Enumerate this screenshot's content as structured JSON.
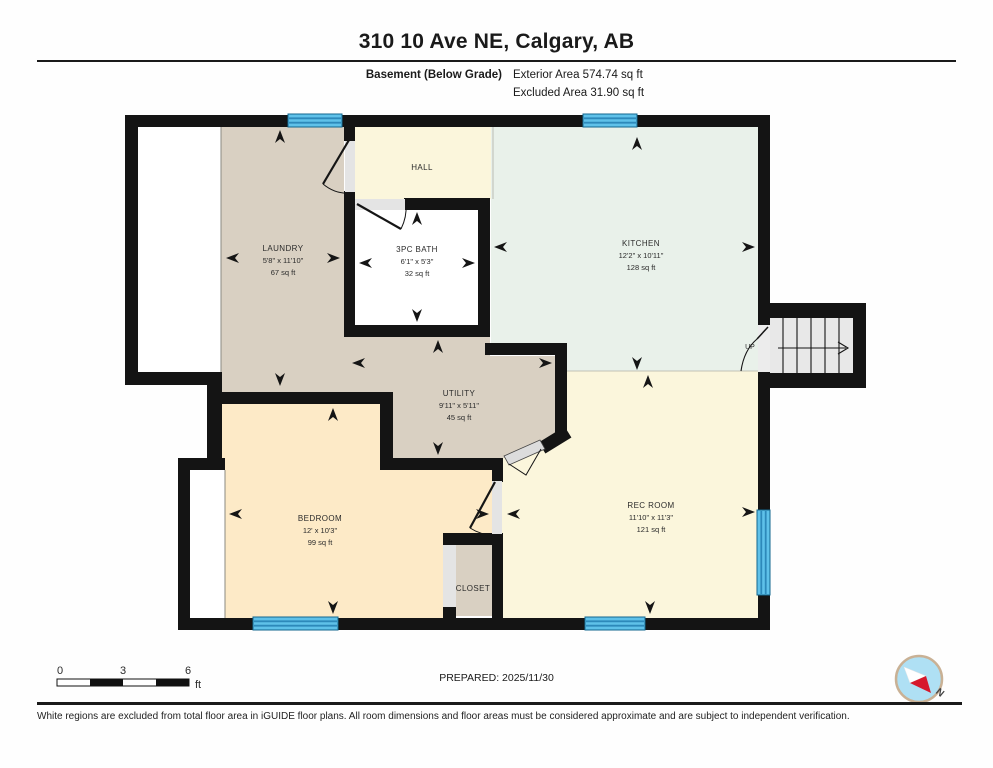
{
  "header": {
    "title": "310 10 Ave NE, Calgary, AB",
    "floor_label": "Basement (Below Grade)",
    "exterior_area": "Exterior Area 574.74 sq ft",
    "excluded_area": "Excluded Area 31.90 sq ft"
  },
  "rooms": {
    "laundry": {
      "name": "LAUNDRY",
      "dimensions": "5'8\" x 11'10\"",
      "area": "67 sq ft"
    },
    "hall": {
      "name": "HALL"
    },
    "bath": {
      "name": "3PC BATH",
      "dimensions": "6'1\" x 5'3\"",
      "area": "32 sq ft"
    },
    "kitchen": {
      "name": "KITCHEN",
      "dimensions": "12'2\" x 10'11\"",
      "area": "128 sq ft"
    },
    "utility": {
      "name": "UTILITY",
      "dimensions": "9'11\" x 5'11\"",
      "area": "45 sq ft"
    },
    "bedroom": {
      "name": "BEDROOM",
      "dimensions": "12' x 10'3\"",
      "area": "99 sq ft"
    },
    "rec_room": {
      "name": "REC ROOM",
      "dimensions": "11'10\" x 11'3\"",
      "area": "121 sq ft"
    },
    "closet": {
      "name": "CLOSET"
    },
    "stairs": {
      "label": "UP"
    }
  },
  "scale_bar": {
    "tick_0": "0",
    "tick_3": "3",
    "tick_6": "6",
    "unit": "ft"
  },
  "footer": {
    "prepared": "PREPARED: 2025/11/30",
    "disclaimer": "White regions are excluded from total floor area in iGUIDE floor plans. All room dimensions and floor areas must be considered approximate and are subject to independent verification.",
    "compass_north": "N"
  },
  "palette": {
    "wall": "#141414",
    "laundry_utility_closet": "#d9d0c2",
    "hall_rec_room": "#fbf6dc",
    "kitchen": "#e9f1ea",
    "bedroom": "#fdeac7",
    "window_blue": "#5fc1e9",
    "window_stripe": "#2d89ba",
    "excluded_region": "#ffffff",
    "stairs_gray": "#e8e8e8",
    "compass_red": "#d6182c",
    "compass_blue": "#afe0f4"
  }
}
